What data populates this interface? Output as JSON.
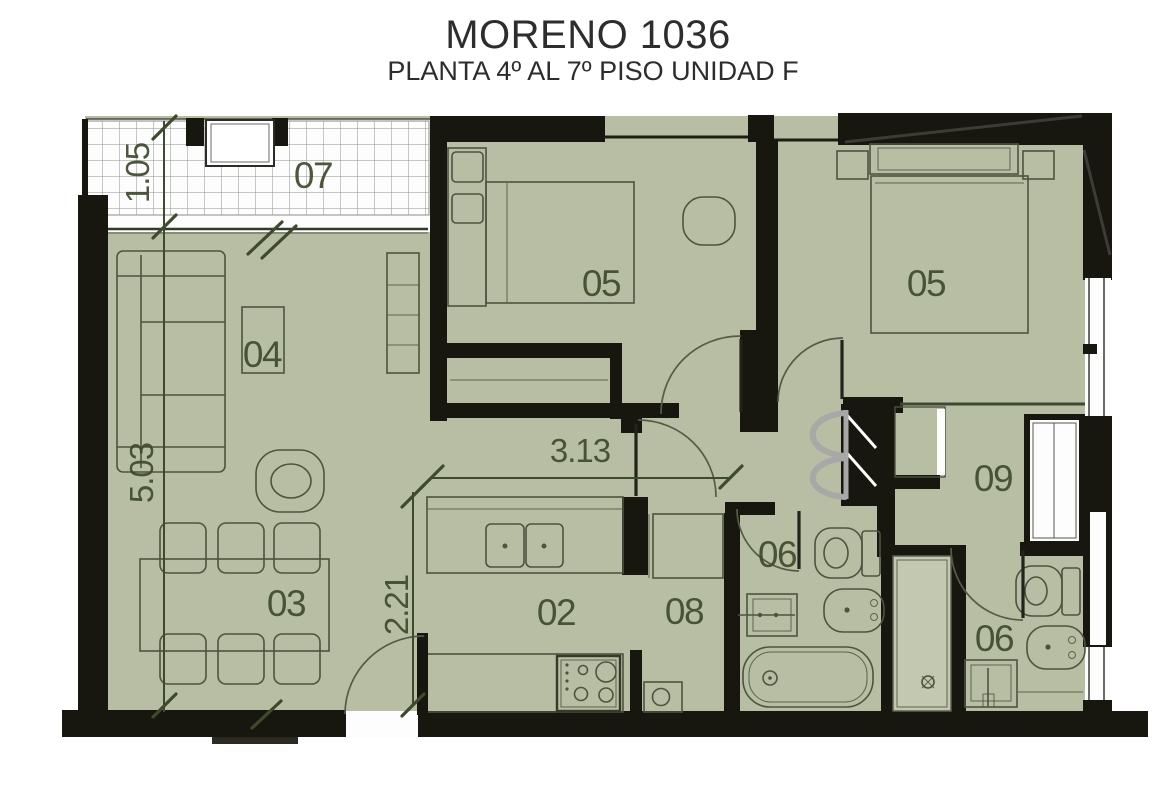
{
  "header": {
    "title": "MORENO 1036",
    "subtitle": "PLANTA 4º AL 7º PISO UNIDAD F"
  },
  "rooms": {
    "kitchen": {
      "number": "02"
    },
    "dining": {
      "number": "03"
    },
    "living": {
      "number": "04"
    },
    "bedroom_1": {
      "number": "05"
    },
    "bedroom_2": {
      "number": "05"
    },
    "bathroom_1": {
      "number": "06"
    },
    "bathroom_2": {
      "number": "06"
    },
    "balcony": {
      "number": "07"
    },
    "laundry": {
      "number": "08"
    },
    "dressing": {
      "number": "09"
    }
  },
  "dimensions": {
    "balcony_depth": "1.05",
    "living_length": "5.03",
    "kitchen_width": "3.13",
    "kitchen_depth": "2.21"
  },
  "colors": {
    "floor": "#b8bea4",
    "wall": "#17160f",
    "line": "#4e5340",
    "label": "#3e4a2c",
    "title": "#2d2d2f",
    "fold_door": "#a8a8a6"
  }
}
